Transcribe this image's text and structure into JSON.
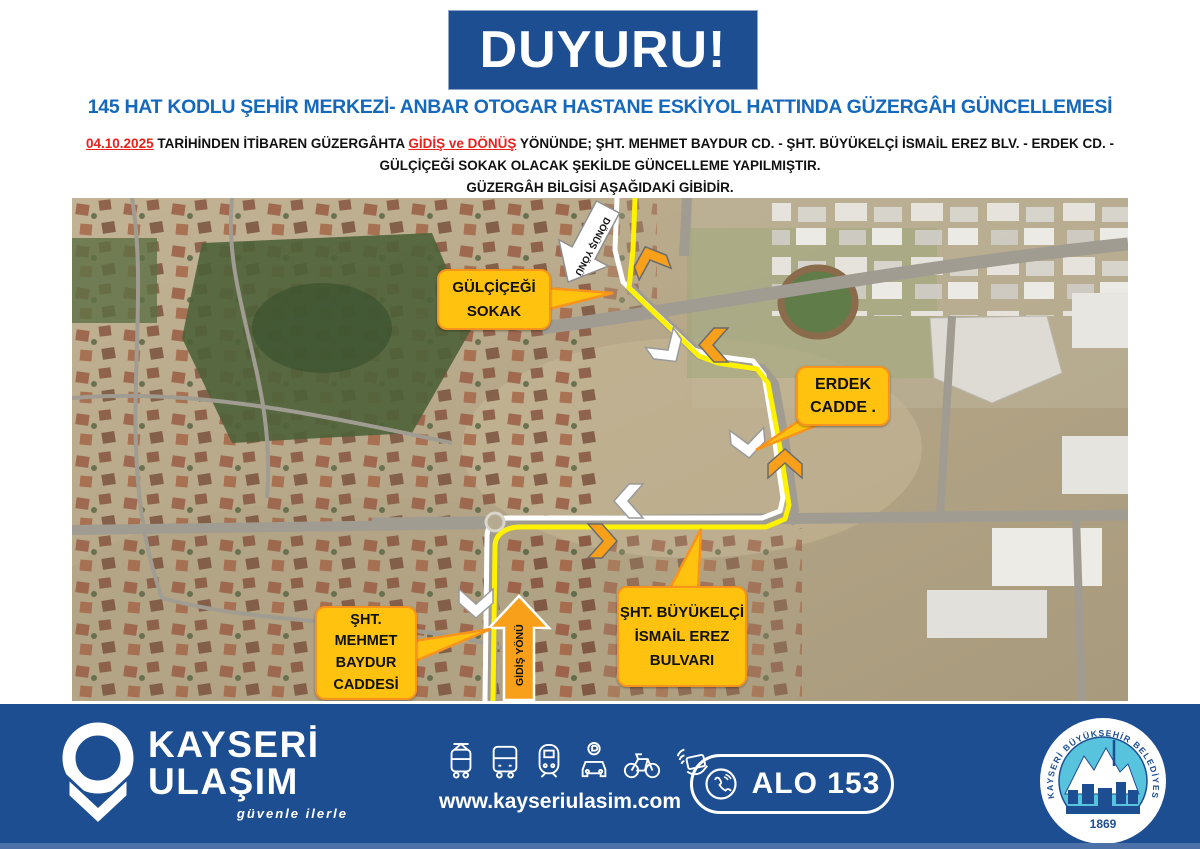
{
  "banner": {
    "text": "DUYURU!"
  },
  "title": "145 HAT KODLU ŞEHİR MERKEZİ- ANBAR OTOGAR HASTANE ESKİYOL HATTINDA GÜZERGÂH GÜNCELLEMESİ",
  "detail": {
    "date": "04.10.2025",
    "part1": "TARİHİNDEN İTİBAREN GÜZERGÂHTA",
    "highlight": "GİDİŞ ve DÖNÜŞ",
    "part2": "YÖNÜNDE; ŞHT. MEHMET BAYDUR CD. - ŞHT. BÜYÜKELÇİ İSMAİL EREZ BLV. - ERDEK CD. - GÜLÇİÇEĞİ SOKAK OLACAK ŞEKİLDE GÜNCELLEME YAPILMIŞTIR."
  },
  "subtitle": "GÜZERGÂH BİLGİSİ AŞAĞIDAKİ GİBİDİR.",
  "map": {
    "bubbles": {
      "gulcicegi_sokak": "GÜLÇİÇEĞİ SOKAK",
      "erdek_cadde": "ERDEK CADDE .",
      "mehmet_baydur": "ŞHT. MEHMET BAYDUR CADDESİ",
      "ismail_erez": "ŞHT. BÜYÜKELÇİ İSMAİL EREZ BULVARI"
    },
    "directions": {
      "donus": "DÖNÜŞ YÖNÜ",
      "gidis": "GİDİŞ YÖNÜ"
    }
  },
  "footer": {
    "brand": {
      "line1": "KAYSERİ",
      "line2": "ULAŞIM",
      "tagline": "güvenle ilerle"
    },
    "website": "www.kayseriulasim.com",
    "hotline": "ALO 153",
    "seal": {
      "ring_text": "KAYSERİ BÜYÜKŞEHİR BELEDİYESİ",
      "year": "1869"
    },
    "icons": [
      "tram",
      "bus",
      "train",
      "car-parking",
      "bicycle",
      "contactless-card"
    ]
  },
  "colors": {
    "navy": "#1d4e91",
    "title_blue": "#1569bd",
    "alert_red": "#e8221a",
    "bubble_yellow": "#ffc20e",
    "bubble_border": "#f7941d",
    "route_yellow": "#fff200",
    "arrow_orange": "#f9a01b",
    "footer_strip": "#4c70a8"
  }
}
